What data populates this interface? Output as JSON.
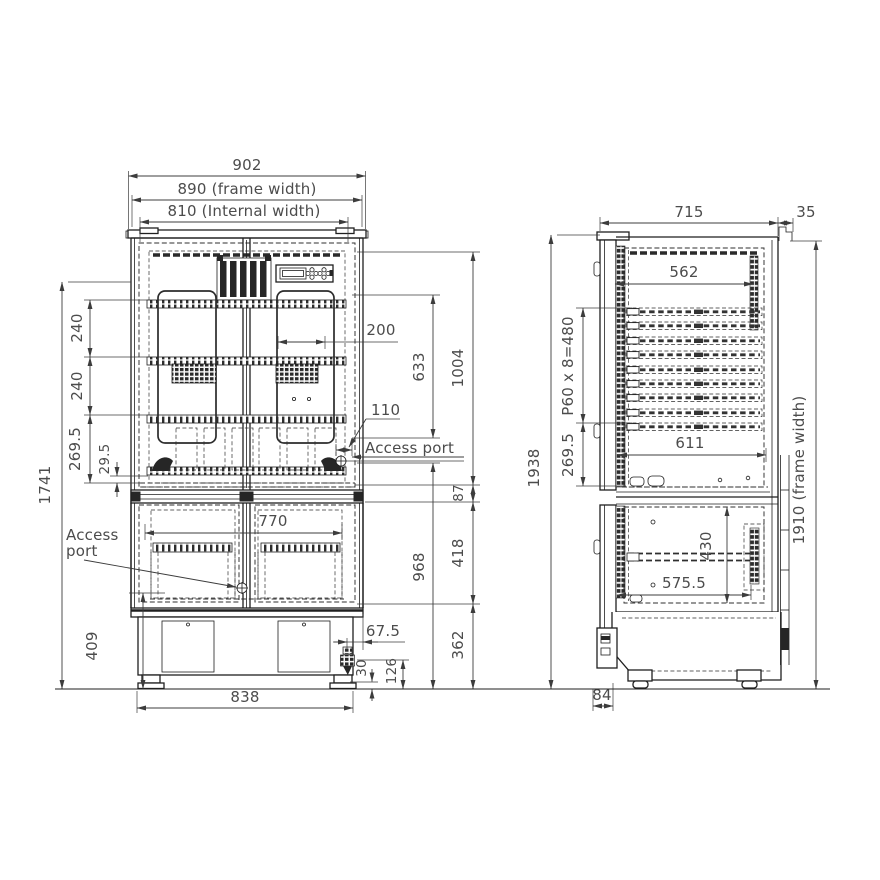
{
  "front_view": {
    "overall_width": "902",
    "frame_width": "890 (frame width)",
    "internal_width": "810 (Internal width)",
    "shelf_pitch_top": "240",
    "shelf_pitch_mid": "240",
    "bottom_section_height": "269.5",
    "floor_clearance": "29.5",
    "door_height": "1741",
    "base_height": "409",
    "access_port_left": {
      "line1": "Access",
      "line2": "port"
    },
    "access_port_right": "Access port",
    "port_offset": "110",
    "duct_width": "200",
    "upper_shelf_span": "633",
    "upper_inner_height": "1004",
    "divider_height": "87",
    "lower_inner_height": "418",
    "lower_section_height": "968",
    "base_section_height": "362",
    "lower_internal_width": "770",
    "drain_offset": "67.5",
    "drain_clearance": "30",
    "drain_height": "126",
    "foot_span": "838"
  },
  "side_view": {
    "depth": "715",
    "wall_clearance": "35",
    "inner_depth_top": "562",
    "rail_pitch": "P60 x 8=480",
    "bottom_section_height": "269.5",
    "inner_depth": "611",
    "overall_height": "1938",
    "frame_height": "1910 (frame width)",
    "lower_inner_height": "430",
    "lower_inner_depth": "575.5",
    "door_offset": "84"
  }
}
